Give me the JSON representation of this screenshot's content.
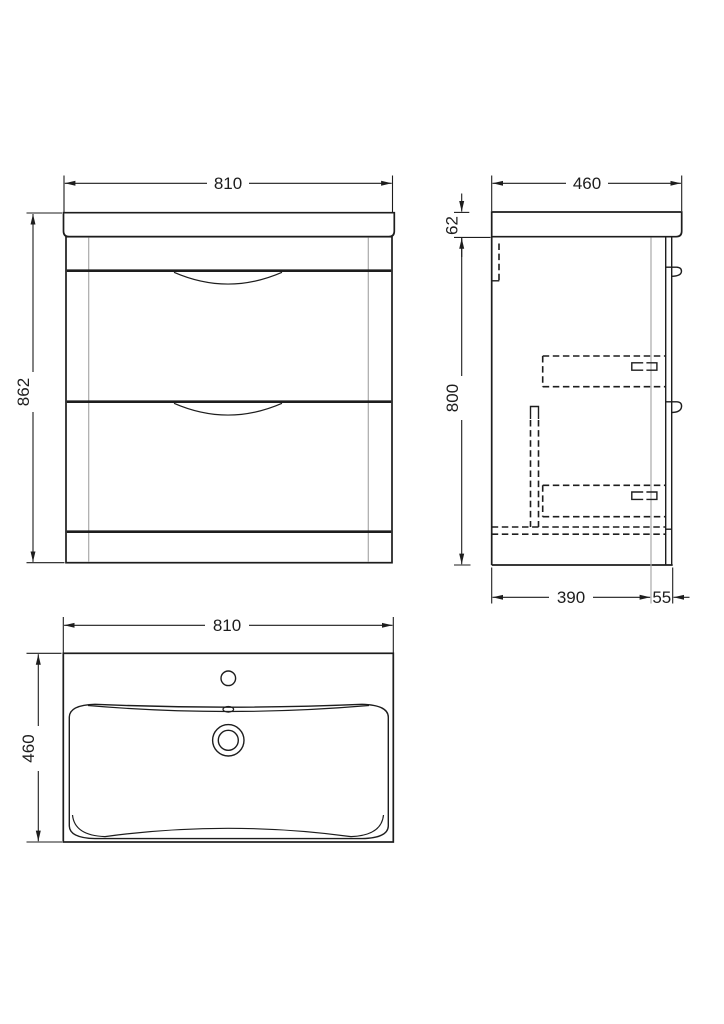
{
  "colors": {
    "line": "#1d1d1d",
    "construction_line": "#a9a9a9",
    "background": "#ffffff"
  },
  "views": {
    "front": {
      "width": "810",
      "height": "862"
    },
    "side": {
      "width": "460",
      "worktop_height": "62",
      "cabinet_height": "800",
      "depth": "390",
      "drawer_front_depth": "55"
    },
    "plan": {
      "width": "810",
      "depth": "460"
    }
  }
}
